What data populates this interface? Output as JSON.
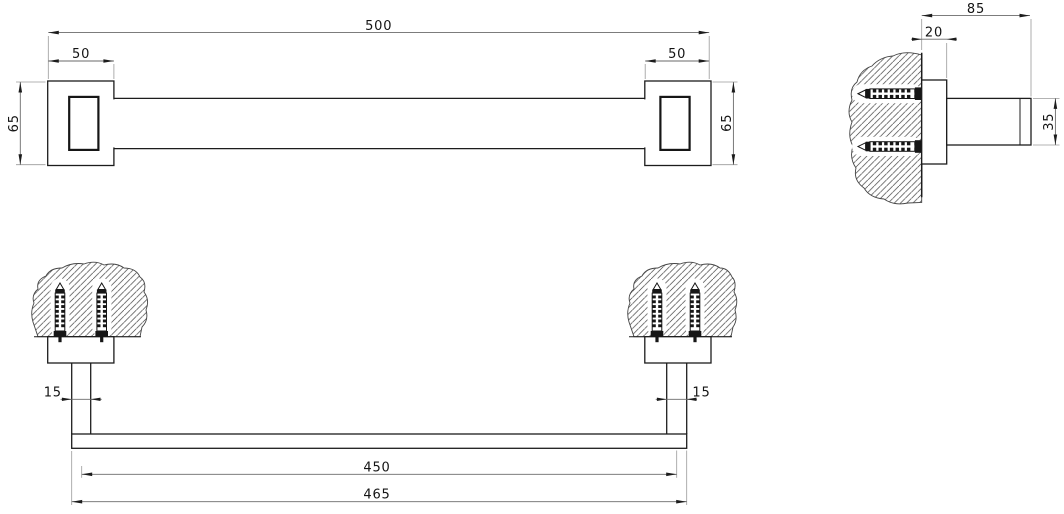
{
  "drawing": {
    "type": "technical-orthographic-drawing",
    "subject": "wall-mounted square towel bar with fixing anchors",
    "colors": {
      "background": "#ffffff",
      "object_line": "#1c1c1c",
      "dimension_line": "#6a6a6a",
      "extension_line": "#9a9a9a",
      "hatch_line": "#454545",
      "text": "#141414"
    },
    "dims": {
      "d500": "500",
      "d50_left": "50",
      "d50_right": "50",
      "d65_left": "65",
      "d65_right": "65",
      "d85": "85",
      "d20": "20",
      "d35": "35",
      "d15_left": "15",
      "d15_right": "15",
      "d450": "450",
      "d465": "465"
    }
  }
}
